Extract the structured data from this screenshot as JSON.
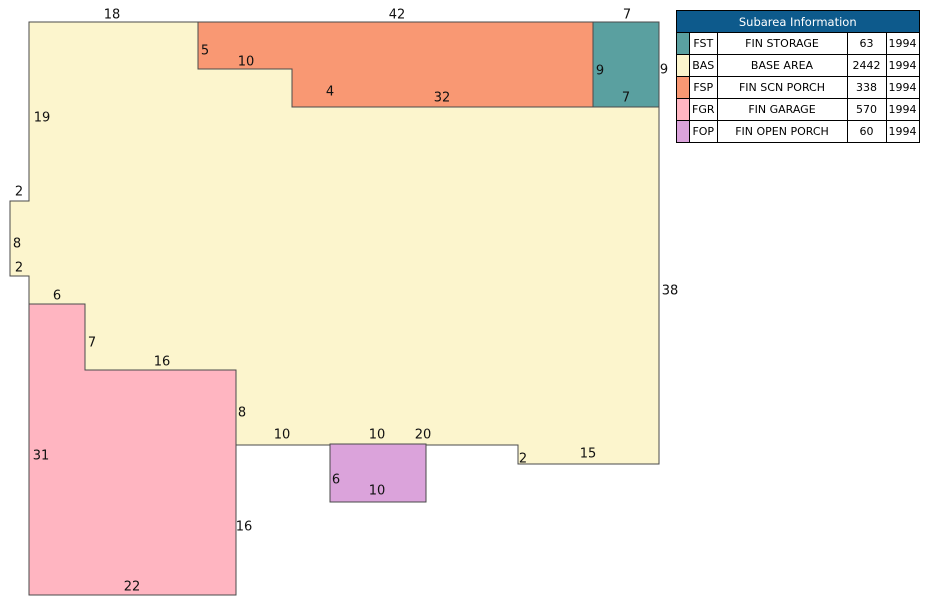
{
  "table": {
    "title": "Subarea Information",
    "header_bg": "#0d5a8c",
    "rows": [
      {
        "code": "FST",
        "description": "FIN STORAGE",
        "area": "63",
        "year": "1994",
        "color": "#5aa0a0"
      },
      {
        "code": "BAS",
        "description": "BASE AREA",
        "area": "2442",
        "year": "1994",
        "color": "#fcf5cd"
      },
      {
        "code": "FSP",
        "description": "FIN SCN PORCH",
        "area": "338",
        "year": "1994",
        "color": "#f99873"
      },
      {
        "code": "FGR",
        "description": "FIN GARAGE",
        "area": "570",
        "year": "1994",
        "color": "#ffb5c1"
      },
      {
        "code": "FOP",
        "description": "FIN OPEN PORCH",
        "area": "60",
        "year": "1994",
        "color": "#dba3db"
      }
    ]
  },
  "sketch": {
    "stroke": "#4a4a4a",
    "label_color": "#111111",
    "subareas": [
      {
        "code": "BAS",
        "name": "base-area",
        "color": "#fcf5cd",
        "points": [
          [
            29,
            22
          ],
          [
            198,
            22
          ],
          [
            198,
            69
          ],
          [
            292,
            69
          ],
          [
            292,
            107
          ],
          [
            659,
            107
          ],
          [
            659,
            464
          ],
          [
            518,
            464
          ],
          [
            518,
            445
          ],
          [
            236,
            445
          ],
          [
            236,
            370
          ],
          [
            85,
            370
          ],
          [
            85,
            304
          ],
          [
            29,
            304
          ],
          [
            29,
            276
          ],
          [
            10,
            276
          ],
          [
            10,
            201
          ],
          [
            29,
            201
          ]
        ]
      },
      {
        "code": "FSP",
        "name": "fin-scn-porch",
        "color": "#f99873",
        "points": [
          [
            198,
            22
          ],
          [
            593,
            22
          ],
          [
            593,
            107
          ],
          [
            292,
            107
          ],
          [
            292,
            69
          ],
          [
            198,
            69
          ]
        ]
      },
      {
        "code": "FST",
        "name": "fin-storage",
        "color": "#5aa0a0",
        "points": [
          [
            593,
            22
          ],
          [
            659,
            22
          ],
          [
            659,
            107
          ],
          [
            593,
            107
          ]
        ]
      },
      {
        "code": "FGR",
        "name": "fin-garage",
        "color": "#ffb5c1",
        "points": [
          [
            29,
            304
          ],
          [
            85,
            304
          ],
          [
            85,
            370
          ],
          [
            236,
            370
          ],
          [
            236,
            595
          ],
          [
            29,
            595
          ]
        ]
      },
      {
        "code": "FOP",
        "name": "fin-open-porch",
        "color": "#dba3db",
        "points": [
          [
            330,
            444
          ],
          [
            426,
            444
          ],
          [
            426,
            502
          ],
          [
            330,
            502
          ]
        ]
      }
    ],
    "dimension_labels": [
      {
        "text": "18",
        "x": 112,
        "y": 14
      },
      {
        "text": "42",
        "x": 397,
        "y": 14
      },
      {
        "text": "7",
        "x": 627,
        "y": 14
      },
      {
        "text": "5",
        "x": 205,
        "y": 50
      },
      {
        "text": "10",
        "x": 246,
        "y": 61
      },
      {
        "text": "9",
        "x": 600,
        "y": 70
      },
      {
        "text": "9",
        "x": 664,
        "y": 69
      },
      {
        "text": "4",
        "x": 330,
        "y": 91
      },
      {
        "text": "32",
        "x": 442,
        "y": 97
      },
      {
        "text": "7",
        "x": 626,
        "y": 97
      },
      {
        "text": "19",
        "x": 42,
        "y": 117
      },
      {
        "text": "2",
        "x": 19,
        "y": 191
      },
      {
        "text": "8",
        "x": 17,
        "y": 243
      },
      {
        "text": "2",
        "x": 19,
        "y": 267
      },
      {
        "text": "38",
        "x": 670,
        "y": 290
      },
      {
        "text": "6",
        "x": 57,
        "y": 295
      },
      {
        "text": "7",
        "x": 92,
        "y": 342
      },
      {
        "text": "16",
        "x": 162,
        "y": 361
      },
      {
        "text": "8",
        "x": 242,
        "y": 412
      },
      {
        "text": "10",
        "x": 282,
        "y": 434
      },
      {
        "text": "10",
        "x": 377,
        "y": 434
      },
      {
        "text": "20",
        "x": 423,
        "y": 434
      },
      {
        "text": "15",
        "x": 588,
        "y": 453
      },
      {
        "text": "31",
        "x": 41,
        "y": 455
      },
      {
        "text": "2",
        "x": 523,
        "y": 458
      },
      {
        "text": "6",
        "x": 336,
        "y": 479
      },
      {
        "text": "10",
        "x": 377,
        "y": 490
      },
      {
        "text": "16",
        "x": 244,
        "y": 526
      },
      {
        "text": "22",
        "x": 132,
        "y": 586
      }
    ]
  }
}
